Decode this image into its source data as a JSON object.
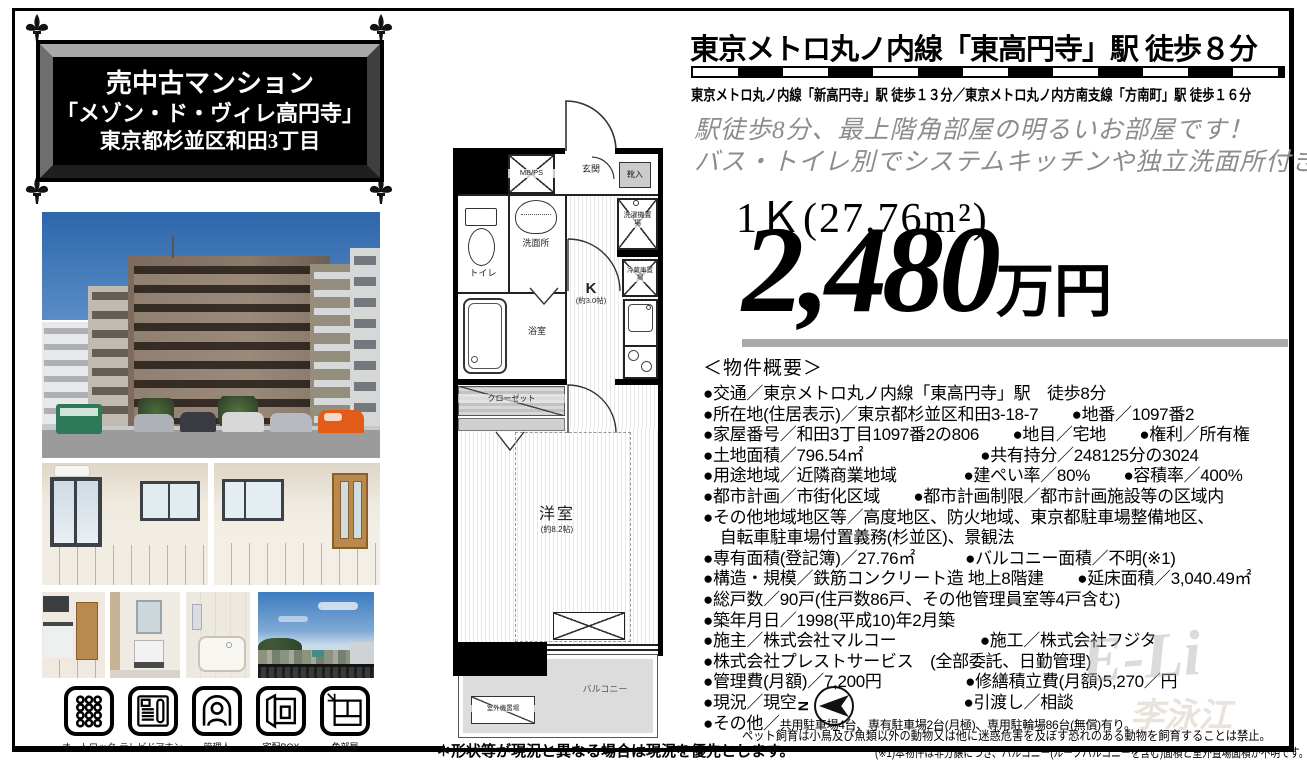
{
  "title_box": {
    "line1": "売中古マンション",
    "line2": "「メゾン・ド・ヴィレ高円寺」",
    "line3": "東京都杉並区和田3丁目"
  },
  "header": {
    "main": "東京メトロ丸ノ内線「東高円寺」駅 徒歩８分",
    "sub": "東京メトロ丸ノ内線「新高円寺」駅 徒歩１３分／東京メトロ丸ノ内方南支線「方南町」駅 徒歩１６分"
  },
  "catch": {
    "line1": "駅徒歩8分、最上階角部屋の明るいお部屋です！",
    "line2": "バス・トイレ別でシステムキッチンや独立洗面所付き"
  },
  "price": {
    "layout_size": "1Ｋ(27.76m²)",
    "amount": "2,480",
    "unit": "万円"
  },
  "overview": {
    "heading": "＜物件概要＞",
    "lines": [
      "●交通／東京メトロ丸ノ内線「東高円寺」駅　徒歩8分",
      "●所在地(住居表示)／東京都杉並区和田3-18-7　　●地番／1097番2",
      "●家屋番号／和田3丁目1097番2の806　　●地目／宅地　　●権利／所有権",
      "●土地面積／796.54㎡　　　　　　　●共有持分／248125分の3024",
      "●用途地域／近隣商業地域　　　　●建ぺい率／80%　　●容積率／400%",
      "●都市計画／市街化区域　　●都市計画制限／都市計画施設等の区域内",
      "●その他地域地区等／高度地区、防火地域、東京都駐車場整備地区、",
      "　自転車駐車場付置義務(杉並区)、景観法",
      "●専有面積(登記簿)／27.76㎡　　　●バルコニー面積／不明(※1)",
      "●構造・規模／鉄筋コンクリート造 地上8階建　　●延床面積／3,040.49㎡",
      "●総戸数／90戸(住戸数86戸、その他管理員室等4戸含む)",
      "●築年月日／1998(平成10)年2月築",
      "●施主／株式会社マルコー　　　　　●施工／株式会社フジタ",
      "●株式会社プレストサービス　(全部委託、日勤管理)",
      "●管理費(月額)／7,200円　　　　　●修繕積立費(月額)5,270／円",
      "●現況／現空　　　　　　　　　　●引渡し／相談"
    ],
    "other_label": "●その他／",
    "other_value": "共用駐車場4台、専有駐車場2台(月極)、専用駐輪場86台(無償)有り。"
  },
  "notes": {
    "pet": "ペット飼育は小鳥及び魚類以外の動物又は他に迷惑危害を及ぼす恐れのある動物を飼育することは禁止。",
    "note1": "(※1)本物件は非分譲につき、バルコニー(ルーフバルコニーを含む)面積と室外置場面積が不明です。",
    "shape": "＊形状等が現況と異なる場合は現況を優先とします。"
  },
  "floorplan": {
    "labels": {
      "mbps": "MB/PS",
      "genkan": "玄関",
      "shoes": "靴入",
      "washer": "洗濯機置場",
      "fridge": "冷蔵庫置場",
      "toilet": "トイレ",
      "wash": "洗面所",
      "bath": "浴室",
      "closet": "クローゼット",
      "kitchen": "K",
      "kitchen_size": "(約3.0帖)",
      "room": "洋室",
      "room_size": "(約8.2帖)",
      "balcony": "バルコニー",
      "outdoor_unit": "室外機置場"
    },
    "compass_letter": "N"
  },
  "icons": {
    "items": [
      {
        "label": "オートロック"
      },
      {
        "label": "テレビドアホン"
      },
      {
        "label": "管理人"
      },
      {
        "label": "宅配BOX"
      },
      {
        "label": "角部屋"
      }
    ]
  },
  "watermark": {
    "line1": "E-Li",
    "line2": "李泳江"
  },
  "colors": {
    "accent_black": "#000000",
    "catch_gray": "#8c8c8c",
    "price_underline": "#a9a9a9",
    "balcony_gray": "#dcdcdc",
    "orange_car": "#e25c17"
  }
}
